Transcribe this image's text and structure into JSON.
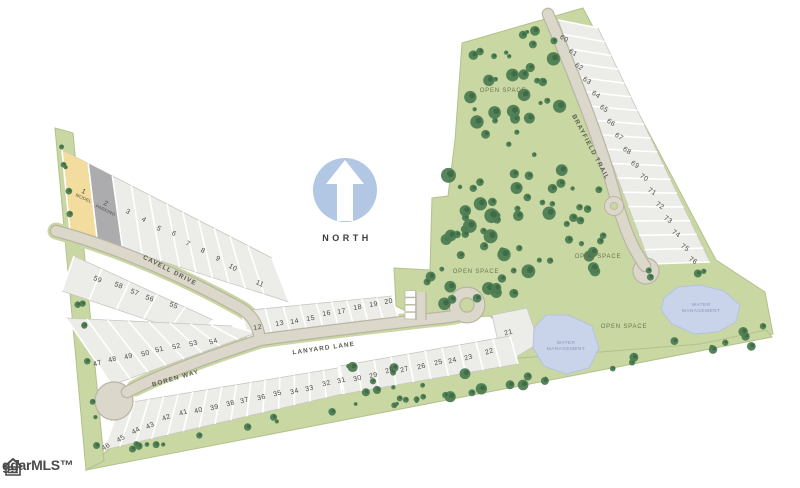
{
  "north_label": "NORTH",
  "logo": {
    "text": "ggarMLS™"
  },
  "colors": {
    "site_green": "#c9d7a3",
    "green_edge": "#b3c18c",
    "tree_green": "#4e7d53",
    "tree_dark": "#3a6743",
    "road": "#dbd8cb",
    "road_edge": "#b9b5a2",
    "lot_fill": "#ecece9",
    "lot_edge": "#c8c7bf",
    "lot1_model_fill": "#f2dc9e",
    "lot2_parking_fill": "#acacae",
    "pond": "#c9d3e9",
    "pond_edge": "#b6c3de",
    "north_circle": "#b1c7e3",
    "number_text": "#4c4c45",
    "road_label_text": "#5c5c54",
    "open_space_text": "#6b7550",
    "water_text": "#8d97b8"
  },
  "roads": [
    {
      "name": "CAVELL DRIVE",
      "x": 169,
      "y": 272,
      "rot": 27
    },
    {
      "name": "BOREN WAY",
      "x": 176,
      "y": 380,
      "rot": -16
    },
    {
      "name": "LANYARD LANE",
      "x": 324,
      "y": 350,
      "rot": -8
    },
    {
      "name": "BRAYFIELD TRAIL",
      "x": 589,
      "y": 148,
      "rot": 62
    }
  ],
  "open_space_labels": [
    {
      "text": "OPEN SPACE",
      "x": 503,
      "y": 92
    },
    {
      "text": "OPEN SPACE",
      "x": 476,
      "y": 273
    },
    {
      "text": "OPEN SPACE",
      "x": 598,
      "y": 258
    },
    {
      "text": "OPEN SPACE",
      "x": 624,
      "y": 328
    }
  ],
  "water_labels": [
    {
      "line1": "WATER",
      "line2": "MANAGEMENT",
      "x": 566,
      "y": 344
    },
    {
      "line1": "WATER",
      "line2": "MANAGEMENT",
      "x": 701,
      "y": 306
    }
  ],
  "lots": [
    {
      "n": "1",
      "x": 83,
      "y": 191,
      "r": 25,
      "sub": "MODEL"
    },
    {
      "n": "2",
      "x": 105,
      "y": 203,
      "r": 25,
      "sub": "PARKING"
    },
    {
      "n": "3",
      "x": 127,
      "y": 211,
      "r": 30
    },
    {
      "n": "4",
      "x": 143,
      "y": 219,
      "r": 30
    },
    {
      "n": "5",
      "x": 158,
      "y": 228,
      "r": 30
    },
    {
      "n": "6",
      "x": 173,
      "y": 233,
      "r": 30
    },
    {
      "n": "7",
      "x": 187,
      "y": 243,
      "r": 30
    },
    {
      "n": "8",
      "x": 202,
      "y": 250,
      "r": 30
    },
    {
      "n": "9",
      "x": 217,
      "y": 258,
      "r": 30
    },
    {
      "n": "10",
      "x": 232,
      "y": 267,
      "r": 30
    },
    {
      "n": "11",
      "x": 259,
      "y": 283,
      "r": 25
    },
    {
      "n": "12",
      "x": 258,
      "y": 327,
      "r": -10
    },
    {
      "n": "13",
      "x": 280,
      "y": 323,
      "r": -10
    },
    {
      "n": "14",
      "x": 295,
      "y": 321,
      "r": -10
    },
    {
      "n": "15",
      "x": 311,
      "y": 318,
      "r": -10
    },
    {
      "n": "16",
      "x": 327,
      "y": 313,
      "r": -10
    },
    {
      "n": "17",
      "x": 342,
      "y": 311,
      "r": -10
    },
    {
      "n": "18",
      "x": 358,
      "y": 307,
      "r": -10
    },
    {
      "n": "19",
      "x": 374,
      "y": 304,
      "r": -10
    },
    {
      "n": "20",
      "x": 389,
      "y": 301,
      "r": -10
    },
    {
      "n": "21",
      "x": 509,
      "y": 332,
      "r": -15
    },
    {
      "n": "22",
      "x": 490,
      "y": 351,
      "r": -18
    },
    {
      "n": "23",
      "x": 469,
      "y": 357,
      "r": -15
    },
    {
      "n": "24",
      "x": 453,
      "y": 360,
      "r": -15
    },
    {
      "n": "25",
      "x": 439,
      "y": 362,
      "r": -15
    },
    {
      "n": "26",
      "x": 422,
      "y": 366,
      "r": -15
    },
    {
      "n": "27",
      "x": 405,
      "y": 369,
      "r": -15
    },
    {
      "n": "28",
      "x": 390,
      "y": 370,
      "r": -15
    },
    {
      "n": "29",
      "x": 374,
      "y": 375,
      "r": -15
    },
    {
      "n": "30",
      "x": 358,
      "y": 378,
      "r": -15
    },
    {
      "n": "31",
      "x": 342,
      "y": 380,
      "r": -15
    },
    {
      "n": "32",
      "x": 327,
      "y": 383,
      "r": -15
    },
    {
      "n": "33",
      "x": 310,
      "y": 388,
      "r": -15
    },
    {
      "n": "34",
      "x": 295,
      "y": 391,
      "r": -15
    },
    {
      "n": "35",
      "x": 278,
      "y": 393,
      "r": -15
    },
    {
      "n": "36",
      "x": 262,
      "y": 397,
      "r": -15
    },
    {
      "n": "37",
      "x": 245,
      "y": 400,
      "r": -15
    },
    {
      "n": "38",
      "x": 231,
      "y": 403,
      "r": -15
    },
    {
      "n": "39",
      "x": 215,
      "y": 407,
      "r": -15
    },
    {
      "n": "40",
      "x": 199,
      "y": 410,
      "r": -15
    },
    {
      "n": "41",
      "x": 184,
      "y": 412,
      "r": -18
    },
    {
      "n": "42",
      "x": 167,
      "y": 417,
      "r": -20
    },
    {
      "n": "43",
      "x": 151,
      "y": 425,
      "r": -25
    },
    {
      "n": "44",
      "x": 137,
      "y": 430,
      "r": -30
    },
    {
      "n": "45",
      "x": 122,
      "y": 438,
      "r": -32
    },
    {
      "n": "46",
      "x": 107,
      "y": 446,
      "r": -32
    },
    {
      "n": "47",
      "x": 98,
      "y": 363,
      "r": -15
    },
    {
      "n": "48",
      "x": 113,
      "y": 359,
      "r": -15
    },
    {
      "n": "49",
      "x": 129,
      "y": 356,
      "r": -15
    },
    {
      "n": "50",
      "x": 146,
      "y": 353,
      "r": -15
    },
    {
      "n": "51",
      "x": 160,
      "y": 349,
      "r": -15
    },
    {
      "n": "52",
      "x": 177,
      "y": 346,
      "r": -15
    },
    {
      "n": "53",
      "x": 194,
      "y": 343,
      "r": -15
    },
    {
      "n": "54",
      "x": 214,
      "y": 341,
      "r": -15
    },
    {
      "n": "55",
      "x": 173,
      "y": 305,
      "r": 20
    },
    {
      "n": "56",
      "x": 149,
      "y": 298,
      "r": 20
    },
    {
      "n": "57",
      "x": 134,
      "y": 292,
      "r": 20
    },
    {
      "n": "58",
      "x": 118,
      "y": 285,
      "r": 20
    },
    {
      "n": "59",
      "x": 97,
      "y": 279,
      "r": 20
    },
    {
      "n": "60",
      "x": 563,
      "y": 38,
      "r": 33
    },
    {
      "n": "61",
      "x": 572,
      "y": 52,
      "r": 33
    },
    {
      "n": "62",
      "x": 578,
      "y": 66,
      "r": 33
    },
    {
      "n": "63",
      "x": 586,
      "y": 80,
      "r": 33
    },
    {
      "n": "64",
      "x": 595,
      "y": 94,
      "r": 33
    },
    {
      "n": "65",
      "x": 603,
      "y": 108,
      "r": 33
    },
    {
      "n": "66",
      "x": 610,
      "y": 122,
      "r": 33
    },
    {
      "n": "67",
      "x": 618,
      "y": 136,
      "r": 33
    },
    {
      "n": "68",
      "x": 626,
      "y": 150,
      "r": 33
    },
    {
      "n": "69",
      "x": 634,
      "y": 164,
      "r": 33
    },
    {
      "n": "70",
      "x": 643,
      "y": 177,
      "r": 33
    },
    {
      "n": "71",
      "x": 651,
      "y": 191,
      "r": 33
    },
    {
      "n": "72",
      "x": 659,
      "y": 205,
      "r": 33
    },
    {
      "n": "73",
      "x": 667,
      "y": 219,
      "r": 33
    },
    {
      "n": "74",
      "x": 675,
      "y": 233,
      "r": 33
    },
    {
      "n": "75",
      "x": 684,
      "y": 247,
      "r": 33
    },
    {
      "n": "76",
      "x": 692,
      "y": 260,
      "r": 33
    }
  ]
}
